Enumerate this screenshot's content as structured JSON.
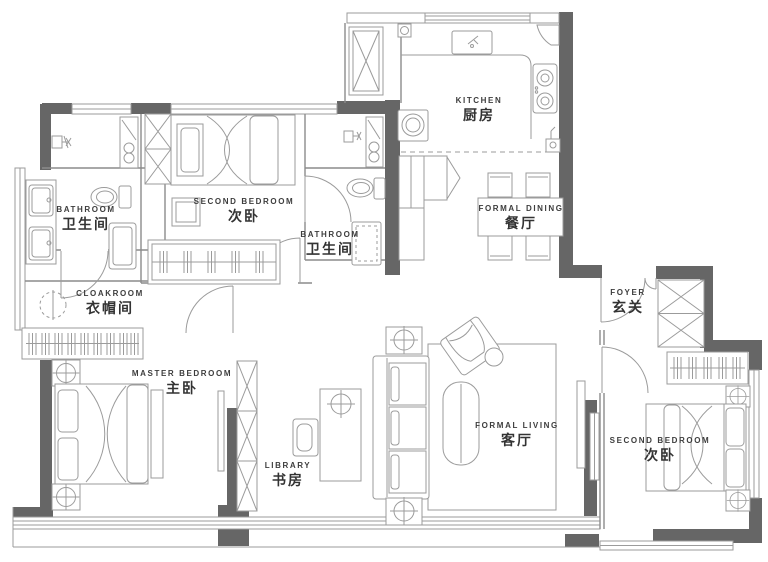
{
  "colors": {
    "wall": "#666666",
    "line": "#9b9b9b",
    "text": "#3d3d3d",
    "background": "#ffffff"
  },
  "rooms": [
    {
      "id": "bathroom-1",
      "en": "BATHROOM",
      "zh": "卫生间"
    },
    {
      "id": "second-bedroom-top",
      "en": "SECOND BEDROOM",
      "zh": "次卧"
    },
    {
      "id": "bathroom-2",
      "en": "BATHROOM",
      "zh": "卫生间"
    },
    {
      "id": "kitchen",
      "en": "KITCHEN",
      "zh": "厨房"
    },
    {
      "id": "formal-dining",
      "en": "FORMAL DINING",
      "zh": "餐厅"
    },
    {
      "id": "cloakroom",
      "en": "CLOAKROOM",
      "zh": "衣帽间"
    },
    {
      "id": "foyer",
      "en": "FOYER",
      "zh": "玄关"
    },
    {
      "id": "master-bedroom",
      "en": "MASTER BEDROOM",
      "zh": "主卧"
    },
    {
      "id": "library",
      "en": "LIBRARY",
      "zh": "书房"
    },
    {
      "id": "formal-living",
      "en": "FORMAL LIVING",
      "zh": "客厅"
    },
    {
      "id": "second-bedroom-right",
      "en": "SECOND BEDROOM",
      "zh": "次卧"
    }
  ]
}
